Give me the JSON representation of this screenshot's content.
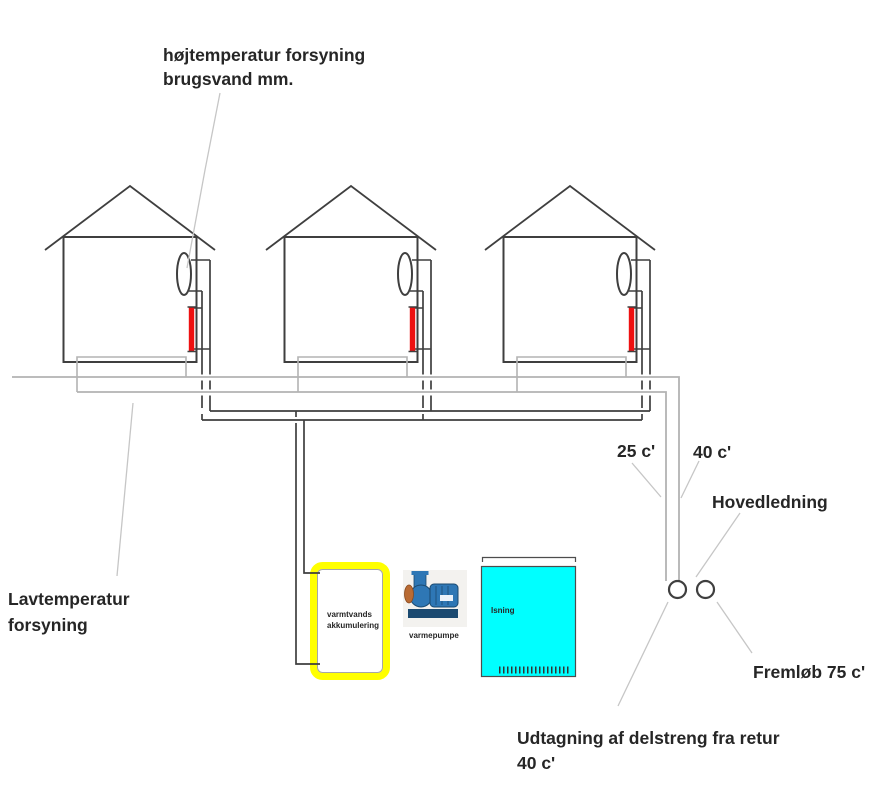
{
  "diagram": {
    "type": "district-heating-schematic",
    "house_count": 3
  },
  "labels": {
    "high_temp_supply": {
      "line1": "højtemperatur forsyning",
      "line2": "brugsvand mm."
    },
    "low_temp_supply": {
      "line1": "Lavtemperatur",
      "line2": "forsyning"
    },
    "return_temp": "25 c'",
    "branch_supply_temp": "40 c'",
    "main_line": "Hovedledning",
    "main_flow": "Fremløb 75 c'",
    "branch_tap": {
      "line1": "Udtagning af delstreng fra retur",
      "line2": "40 c'"
    },
    "accumulator": {
      "line1": "varmtvands",
      "line2": "akkumulering"
    },
    "heat_pump": "varmepumpe",
    "ice_storage": "Isning"
  },
  "colors": {
    "line_dark": "#3f3f3f",
    "pipe_gray": "#b3b3b3",
    "leader_gray": "#c6c6c6",
    "radiator_red": "#ee1111",
    "accumulator_yellow": "#ffff00",
    "ice_tank_cyan": "#00ffff",
    "text": "#262626"
  }
}
